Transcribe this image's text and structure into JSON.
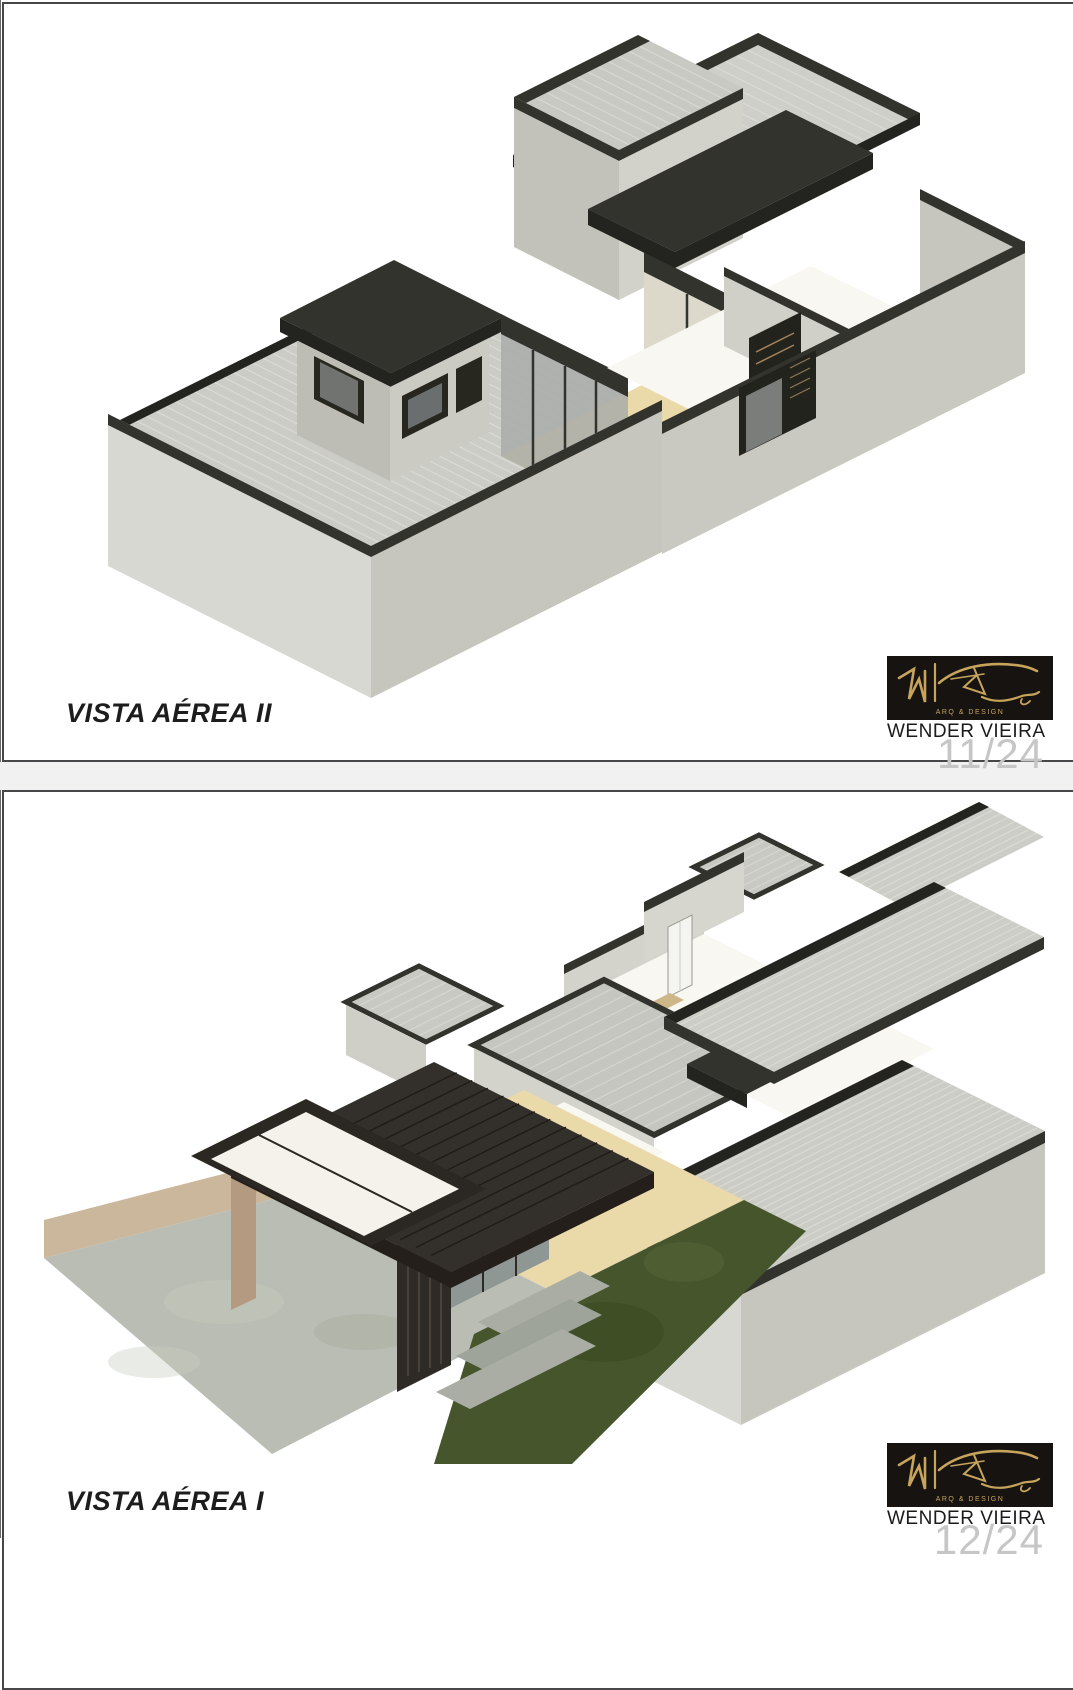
{
  "pages": [
    {
      "title": "VISTA AÉREA II",
      "credit": "WENDER VIEIRA",
      "logo_caption": "ARQ & DESIGN",
      "page_number": "11/24"
    },
    {
      "title": "VISTA AÉREA I",
      "credit": "WENDER VIEIRA",
      "logo_caption": "ARQ & DESIGN",
      "page_number": "12/24"
    }
  ],
  "colors": {
    "charcoal": "#33332e",
    "charcoal2": "#232320",
    "gold": "#c7a45c",
    "floorWhite": "#f8f7f1",
    "floorBeige": "#ead9a9",
    "grass": "#46552c",
    "grassDark": "#39481f",
    "concrete": "#b9bdb3",
    "patio": "#b6bbb0",
    "wallBright": "#d8d8d2",
    "wallMid": "#c6c6bf",
    "wallShade": "#c9c9c2",
    "roofBase": "#ccccc6",
    "roofLine": "#dcdcd6",
    "pageNumber": "#c6c6c6",
    "logoBackground": "#161310"
  }
}
